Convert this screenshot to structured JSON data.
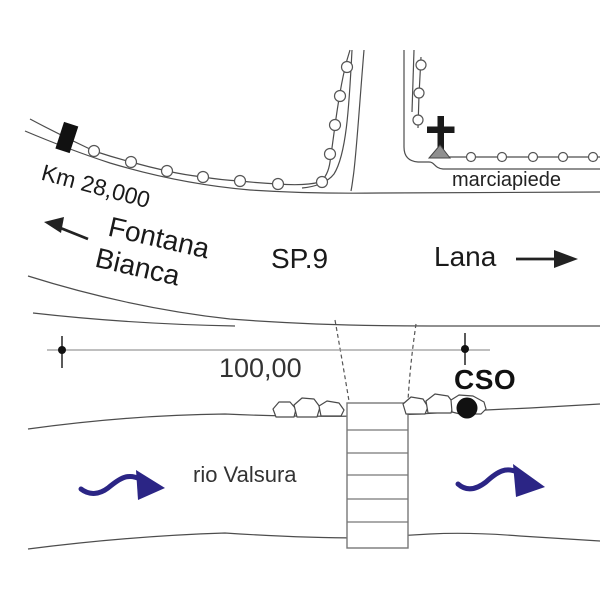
{
  "map": {
    "road": {
      "route_label": "SP.9",
      "km_marker_label": "Km 28,000",
      "direction_left_line1": "Fontana",
      "direction_left_line2": "Bianca",
      "direction_right_label": "Lana",
      "sidewalk_label": "marciapiede"
    },
    "measurement": {
      "distance_label": "100,00"
    },
    "station": {
      "code_label": "CSO"
    },
    "river": {
      "name_label": "rio Valsura"
    }
  },
  "colors": {
    "line": "#4d4d4d",
    "light_line": "#999999",
    "text": "#1a1a1a",
    "flow_arrow": "#2b2585",
    "cross_base_fill": "#8f8f8f",
    "marker_fill": "#111111"
  }
}
